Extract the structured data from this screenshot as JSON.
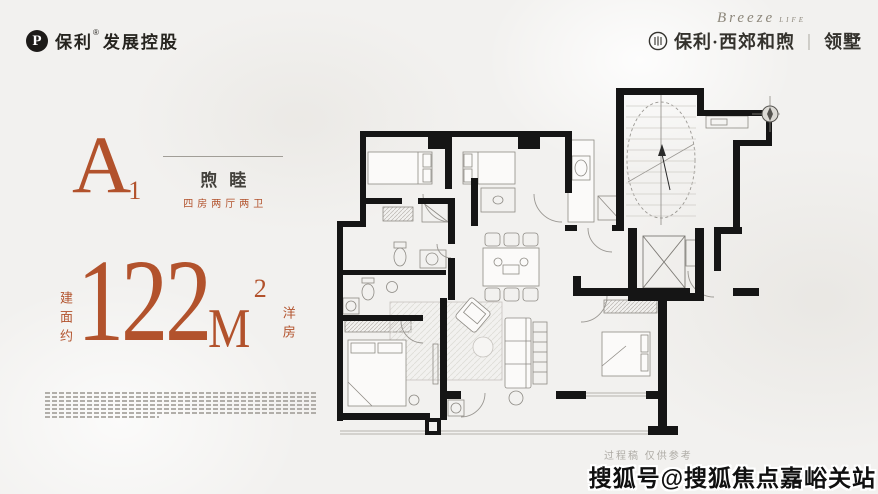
{
  "colors": {
    "background": "#f2f1ef",
    "accent": "#b2522c",
    "wall": "#151515",
    "ink": "#26241f",
    "muted_gray": "#aeaba5"
  },
  "header": {
    "left_logo": {
      "icon": "poly-p-icon",
      "brand": "保利",
      "registered": "®",
      "suffix": "发展控股"
    },
    "right_logo": {
      "icon": "project-seal-icon",
      "script": "Breeze",
      "script_small": "LIFE",
      "project": "保利·西郊和煦",
      "divider": "｜",
      "product": "领墅"
    }
  },
  "unit_card": {
    "code": {
      "letter": "A",
      "sub": "1"
    },
    "name": "煦睦",
    "layout": "四房两厅两卫",
    "area": {
      "vertical_prefix": "建面约",
      "value": "122",
      "unit": "M",
      "exponent": "2",
      "vertical_suffix": "洋房"
    }
  },
  "plan": {
    "draft_note": "过程稿 仅供参考"
  },
  "watermark": "搜狐号@搜狐焦点嘉峪关站",
  "disclaimer": {
    "legible": false,
    "line_count": 7
  }
}
